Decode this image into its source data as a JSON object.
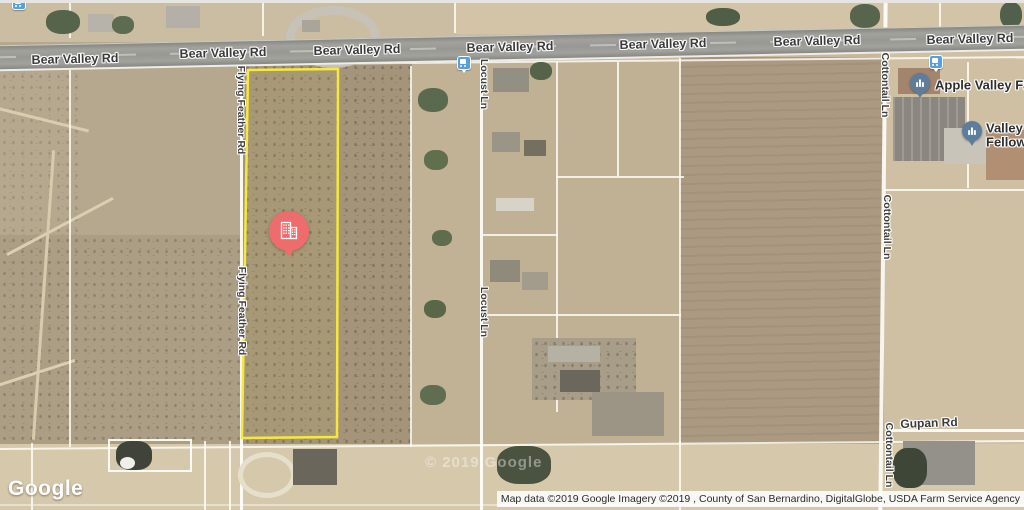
{
  "map": {
    "type": "satellite",
    "road_labels": {
      "bear_valley": "Bear Valley Rd",
      "flying_feather": "Flying Feather Rd",
      "locust": "Locust Ln",
      "cottontail": "Cottontail Ln",
      "gupan": "Gupan Rd"
    },
    "pois": {
      "apple_valley": {
        "label": "Apple Valley Fa",
        "icon": "place-pin-icon"
      },
      "valley_fellowship": {
        "label_line1": "Valley",
        "label_line2": "Fellow",
        "icon": "place-pin-icon"
      }
    },
    "property_marker": {
      "icon": "buildings-icon",
      "color": "#EE6C6C"
    },
    "parcel": {
      "outline_color": "#F6E93B"
    },
    "watermark": "© 2019 Google"
  },
  "footer": {
    "logo_text": "Google",
    "attribution": "Map data ©2019 Google Imagery ©2019 , County of San Bernardino, DigitalGlobe, USDA Farm Service Agency"
  },
  "colors": {
    "marker_red": "#EE6C6C",
    "parcel_yellow": "#F6E93B",
    "pin_blue": "#5E7D9B",
    "transit_blue": "#57A0DC",
    "road_label": "#3B3B3B"
  }
}
